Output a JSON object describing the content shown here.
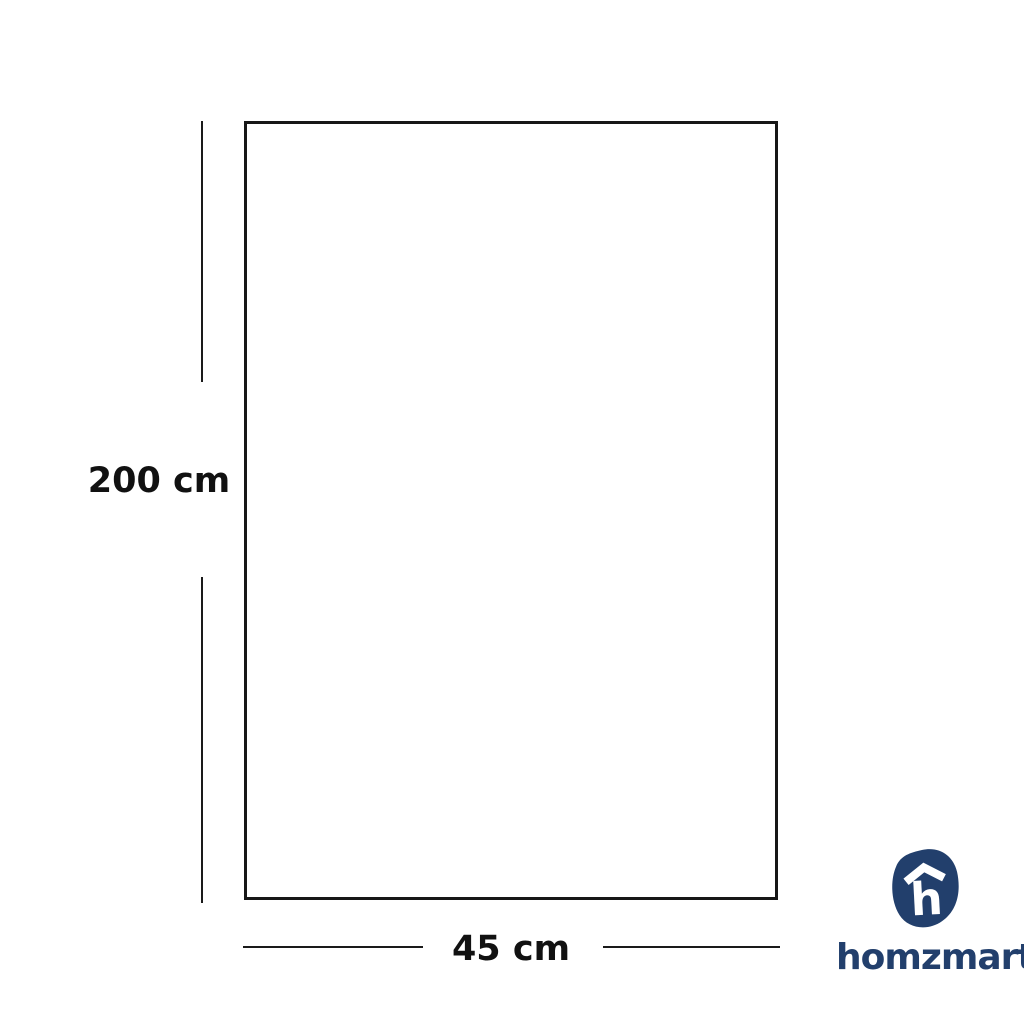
{
  "page": {
    "background": "#ffffff",
    "type": "product-dimension-diagram"
  },
  "diagram": {
    "shape": "rectangle-outline",
    "line_color": "#1a1a1a",
    "height_dimension": {
      "label": "200 cm"
    },
    "width_dimension": {
      "label": "45 cm"
    }
  },
  "brand": {
    "wordmark": "homzmart",
    "icon": "homzmart-house-h-icon",
    "color": "#223f6c"
  }
}
